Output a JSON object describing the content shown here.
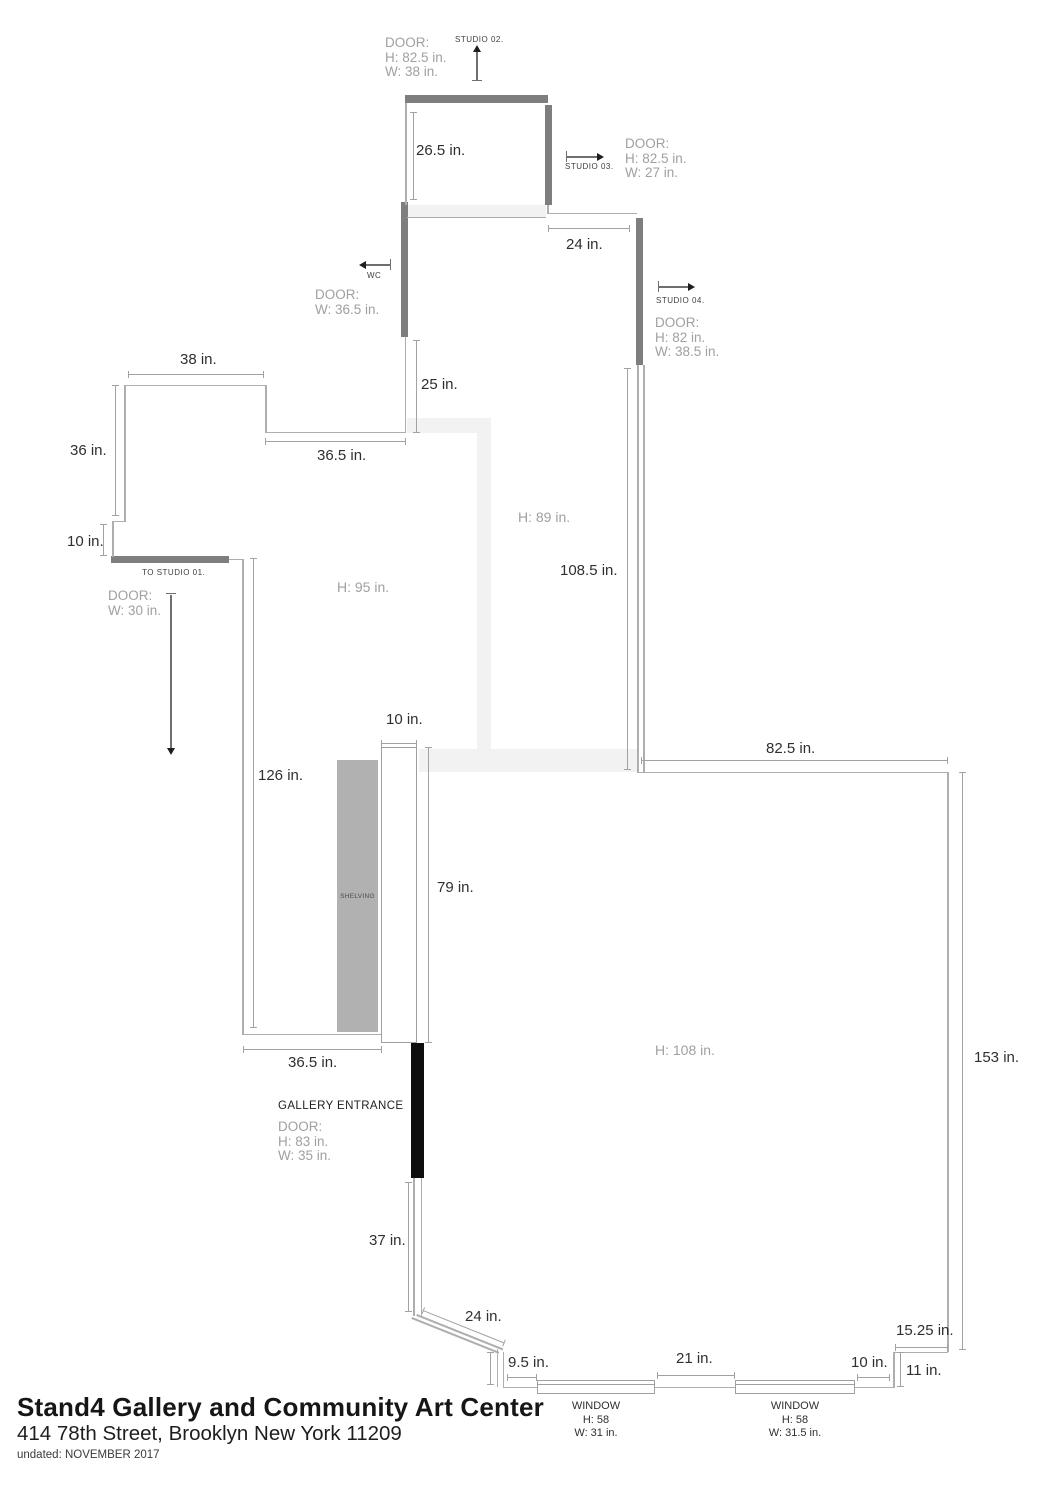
{
  "title_block": {
    "title": "Stand4 Gallery and Community Art Center",
    "address": "414 78th Street, Brooklyn New York 11209",
    "dated": "undated: NOVEMBER 2017"
  },
  "rooms": {
    "h95": "H: 95 in.",
    "h89": "H: 89 in.",
    "h108": "H: 108 in."
  },
  "labels": {
    "studio02": "STUDIO 02.",
    "studio03": "STUDIO 03.",
    "studio04": "STUDIO 04.",
    "wc": "WC",
    "to_studio01": "TO STUDIO 01.",
    "gallery_entrance": "GALLERY ENTRANCE",
    "shelving": "SHELVING"
  },
  "doors": {
    "studio02": {
      "label": "DOOR:",
      "h": "H: 82.5 in.",
      "w": "W: 38 in."
    },
    "studio03": {
      "label": "DOOR:",
      "h": "H: 82.5 in.",
      "w": "W: 27 in."
    },
    "wc": {
      "label": "DOOR:",
      "w": "W: 36.5 in."
    },
    "studio04": {
      "label": "DOOR:",
      "h": "H: 82 in.",
      "w": "W: 38.5 in."
    },
    "studio01": {
      "label": "DOOR:",
      "w": "W: 30 in."
    },
    "gallery": {
      "label": "DOOR:",
      "h": "H: 83 in.",
      "w": "W: 35 in."
    }
  },
  "windows": {
    "left": {
      "label": "WINDOW",
      "h": "H: 58",
      "w": "W: 31 in."
    },
    "right": {
      "label": "WINDOW",
      "h": "H: 58",
      "w": "W: 31.5 in."
    }
  },
  "measurements": {
    "top_room": "26.5 in.",
    "hall_top": "24 in.",
    "wc_wall": "25 in.",
    "mid_wall": "36.5 in.",
    "left_top": "38 in.",
    "left_side": "36 in.",
    "left_step": "10 in.",
    "west_wall": "126 in.",
    "pier_width": "10 in.",
    "pier_length": "79 in.",
    "shelf_width": "36.5 in.",
    "entry_wall": "37 in.",
    "diag_wall": "24 in.",
    "win_gap_left": "9.5 in.",
    "win_gap_mid": "21 in.",
    "win_gap_right": "10 in.",
    "step_height": "11 in.",
    "step_width": "15.25 in.",
    "room_top": "82.5 in.",
    "corridor": "108.5 in.",
    "room_side": "153 in."
  }
}
